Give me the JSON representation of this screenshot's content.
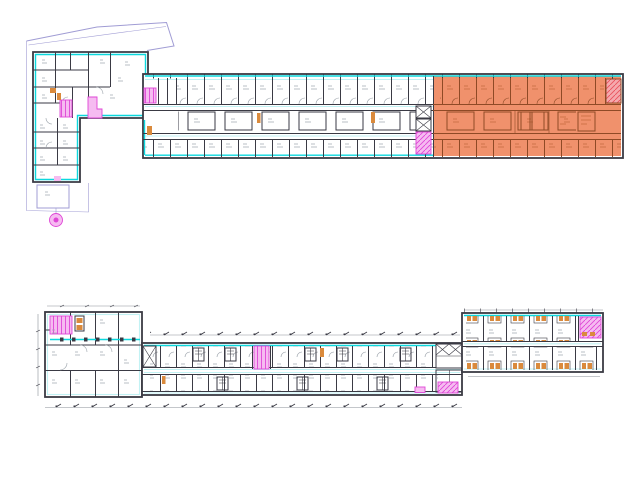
{
  "canvas": {
    "width": 640,
    "height": 479,
    "background": "#ffffff"
  },
  "colors": {
    "wall": "#3a3a44",
    "wlight": "#98a0a8",
    "lbl": "#a4aab4",
    "cyan": "#0cd8de",
    "cyanl": "#c2f2f4",
    "lav": "#a09cd4",
    "mag": "#df46d6",
    "magl": "#f6bbf1",
    "hl": "#f0916c",
    "hlw": "#8f4a26",
    "hll": "#c46a3e",
    "fix": "#da8a3c",
    "red": "#e9525c",
    "redl": "#f5a9ad",
    "dim": "#8a9098",
    "bg": "#ffffff"
  },
  "plans": [
    {
      "id": "upper-floor-plan",
      "position": "top",
      "regions": [
        "site-boundary",
        "left-l-wing",
        "long-east-wing"
      ],
      "highlighted_zone": {
        "present": true,
        "location": "east-section",
        "color_ref": "hl"
      },
      "markers": [
        "magenta-stair-cores",
        "red-hatched-stair",
        "magenta-entry-circle",
        "courtyard-outline"
      ]
    },
    {
      "id": "lower-floor-plan",
      "position": "bottom",
      "regions": [
        "left-block",
        "long-central-wing",
        "northeast-wing"
      ],
      "highlighted_zone": {
        "present": false
      },
      "markers": [
        "magenta-stair-cores",
        "bathroom-pods",
        "dimension-lines"
      ]
    }
  ]
}
